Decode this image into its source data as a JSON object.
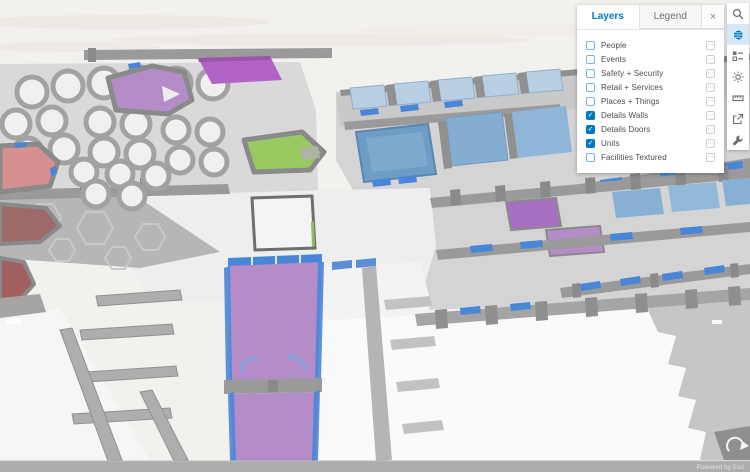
{
  "panel": {
    "tabs": [
      {
        "label": "Layers",
        "active": true
      },
      {
        "label": "Legend",
        "active": false
      }
    ],
    "layers": [
      {
        "label": "People",
        "checked": false
      },
      {
        "label": "Events",
        "checked": false
      },
      {
        "label": "Safety + Security",
        "checked": false
      },
      {
        "label": "Retail + Services",
        "checked": false
      },
      {
        "label": "Places + Things",
        "checked": false
      },
      {
        "label": "Details Walls",
        "checked": true
      },
      {
        "label": "Details Doors",
        "checked": true
      },
      {
        "label": "Units",
        "checked": true
      },
      {
        "label": "Facilities Textured",
        "checked": false
      }
    ]
  },
  "toolbar": {
    "icons": [
      {
        "name": "search",
        "active": false
      },
      {
        "name": "basemap-globe",
        "active": true
      },
      {
        "name": "legend-grid",
        "active": false
      },
      {
        "name": "daylight",
        "active": false
      },
      {
        "name": "measure",
        "active": false
      },
      {
        "name": "share",
        "active": false
      },
      {
        "name": "tools-wrench",
        "active": false
      }
    ]
  },
  "attribution": {
    "text": "Powered by Esri"
  },
  "glyphs": {
    "check": "✓",
    "close": "×",
    "ellipsis": "⋯"
  },
  "colors": {
    "c-accent": "#0079c1",
    "c-purple": "#b48cc8",
    "c-purplebright": "#b263c6",
    "c-green": "#99ca61",
    "c-red": "#d69090",
    "c-maroon": "#9d6a6a",
    "c-darkred": "#a25f5f",
    "c-bluesteel": "#6d9dc5",
    "c-bluelight": "#b9cfe4",
    "c-door": "#4a86d8",
    "c-wall": "#9a9a9a",
    "c-floor": "#d9d9d9",
    "c-bar": "#adadad"
  }
}
